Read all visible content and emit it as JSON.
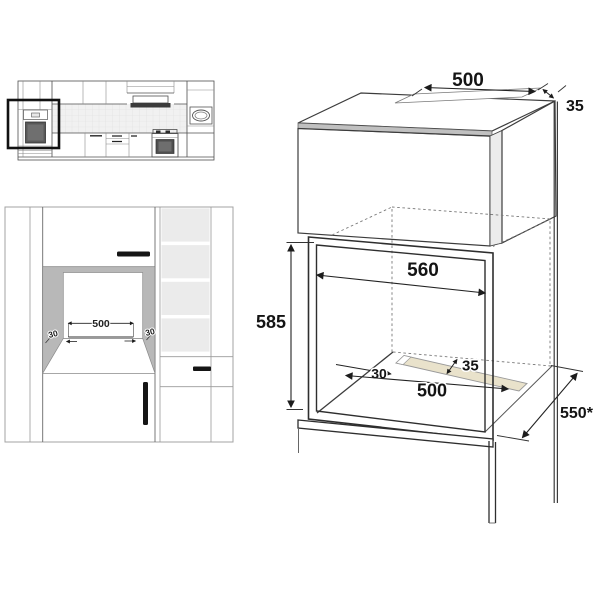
{
  "isometric_view": {
    "top_cutout_width": "500",
    "top_rear_gap": "35",
    "niche_width": "560",
    "niche_height": "585",
    "floor_vent_side_margin": "30",
    "floor_vent_depth": "35",
    "floor_vent_width": "500",
    "cabinet_depth": "550*"
  },
  "front_view": {
    "vent_cutout_width": "500",
    "left_margin": "30",
    "right_margin": "30"
  },
  "colors": {
    "vent_strip": "#e9e2cb",
    "niche_wall_shade": "#b8b8b8",
    "cabinet_top_shade": "#d8d8d8"
  }
}
